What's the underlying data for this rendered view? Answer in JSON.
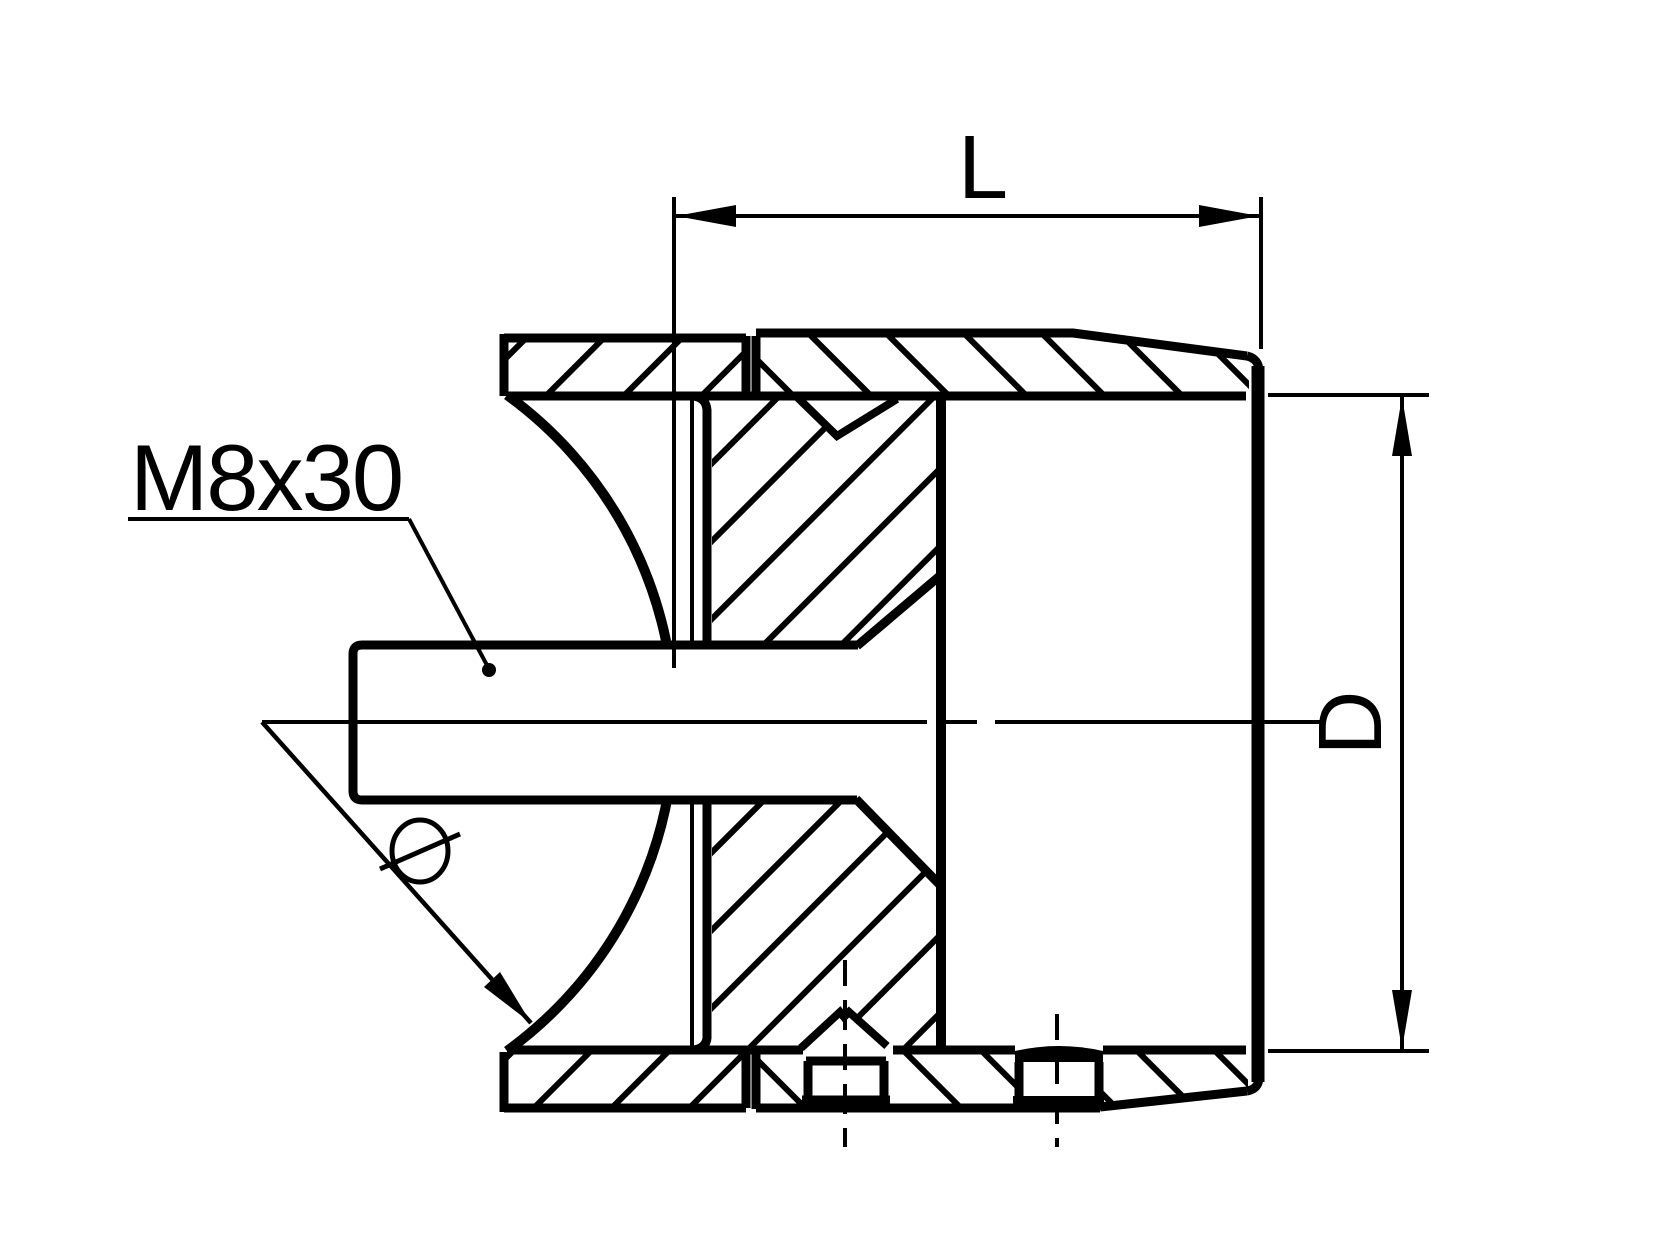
{
  "drawing": {
    "type": "technical-section-drawing",
    "labels": {
      "length_dim": "L",
      "diameter_dim": "D",
      "thread_callout": "M8x30",
      "saddle_diameter_symbol": "Ø"
    },
    "colors": {
      "line": "#000000",
      "background": "#ffffff"
    }
  }
}
